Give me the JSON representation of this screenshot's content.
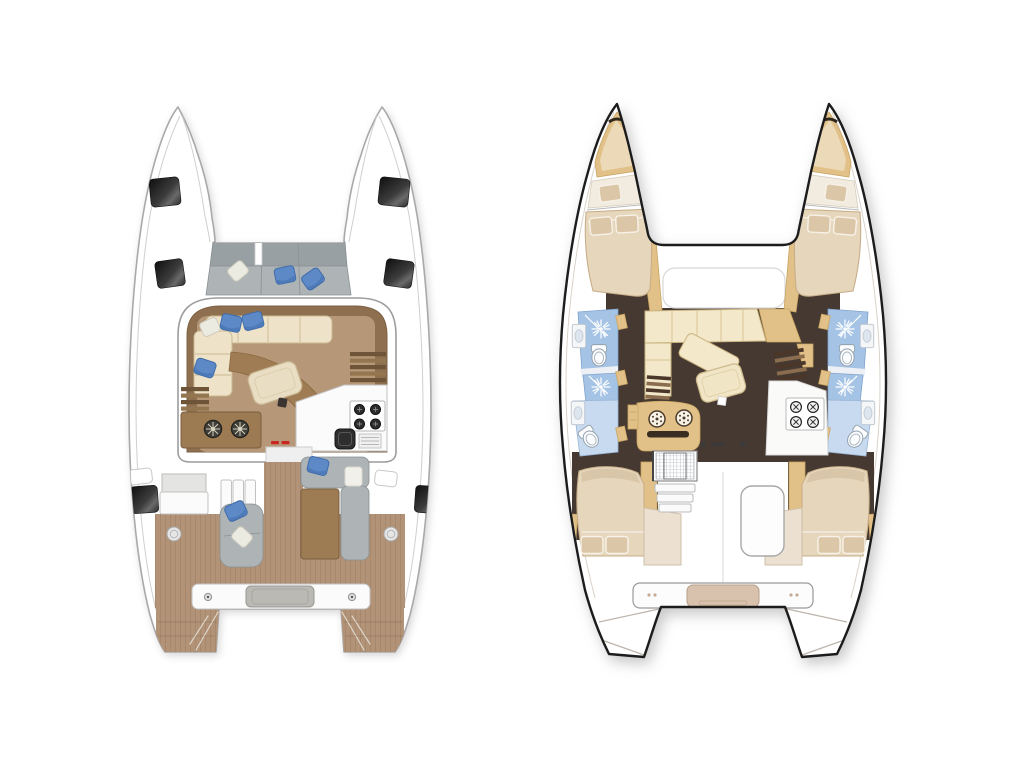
{
  "title": "catamaran-floorplans",
  "background": "#ffffff",
  "colors": {
    "bg": "#ffffff",
    "hullStroke": "#a9a9a9",
    "gray": "#aeb4b6",
    "grayDark": "#99a0a3",
    "bluePillow": "#5d89c6",
    "bluePillowDark": "#3f6cab",
    "wood": "#b29377",
    "woodLight": "#b69878",
    "woodDark": "#8e7050",
    "benchBrown": "#9c7a52",
    "cream": "#eee2c8",
    "creamStroke": "#c9b892",
    "red": "#c82820",
    "outline": "#1c1c1c",
    "choc": "#463931",
    "tan": "#e2c188",
    "tanDark": "#c9a563",
    "bathBlue": "#a5c3e5",
    "bathBlueLight": "#c7daf0",
    "bedCream": "#e6d6bc",
    "bedStroke": "#c8ae89",
    "pillowTan": "#dcc6a8",
    "saloonCream": "#f3e8c9"
  },
  "plans": {
    "deck": {
      "id": "deck-plan",
      "features": [
        "bow-hatches",
        "forward-cockpit-seating",
        "saloon-lounge-sofa",
        "saloon-table",
        "curved-backrest",
        "hull-stairs",
        "chart-bench-fans",
        "galley-stove-4-burner",
        "sink",
        "companionway",
        "aft-chaise",
        "aft-sofa",
        "cockpit-table-pad",
        "deck-hatches",
        "transom-bench",
        "swim-platforms"
      ],
      "window_count": 6,
      "pillow_count": 8
    },
    "interior": {
      "id": "interior-plan",
      "features": [
        "forward-peak",
        "forward-berths",
        "double-berth-fore-port",
        "double-berth-fore-starboard",
        "bathroom-fore-port",
        "shower-port",
        "bathroom-aft-port",
        "bathroom-fore-starboard",
        "shower-starboard",
        "bathroom-aft-starboard",
        "saloon-sofa",
        "saloon-table",
        "galley-2-burner",
        "stove-4-burner",
        "hull-stairs",
        "aft-cabin-port",
        "aft-cabin-starboard",
        "engine-hatch",
        "companionway-steps",
        "transom-bench",
        "swim-platforms"
      ],
      "shower_count": 4,
      "toilet_count": 4
    }
  }
}
